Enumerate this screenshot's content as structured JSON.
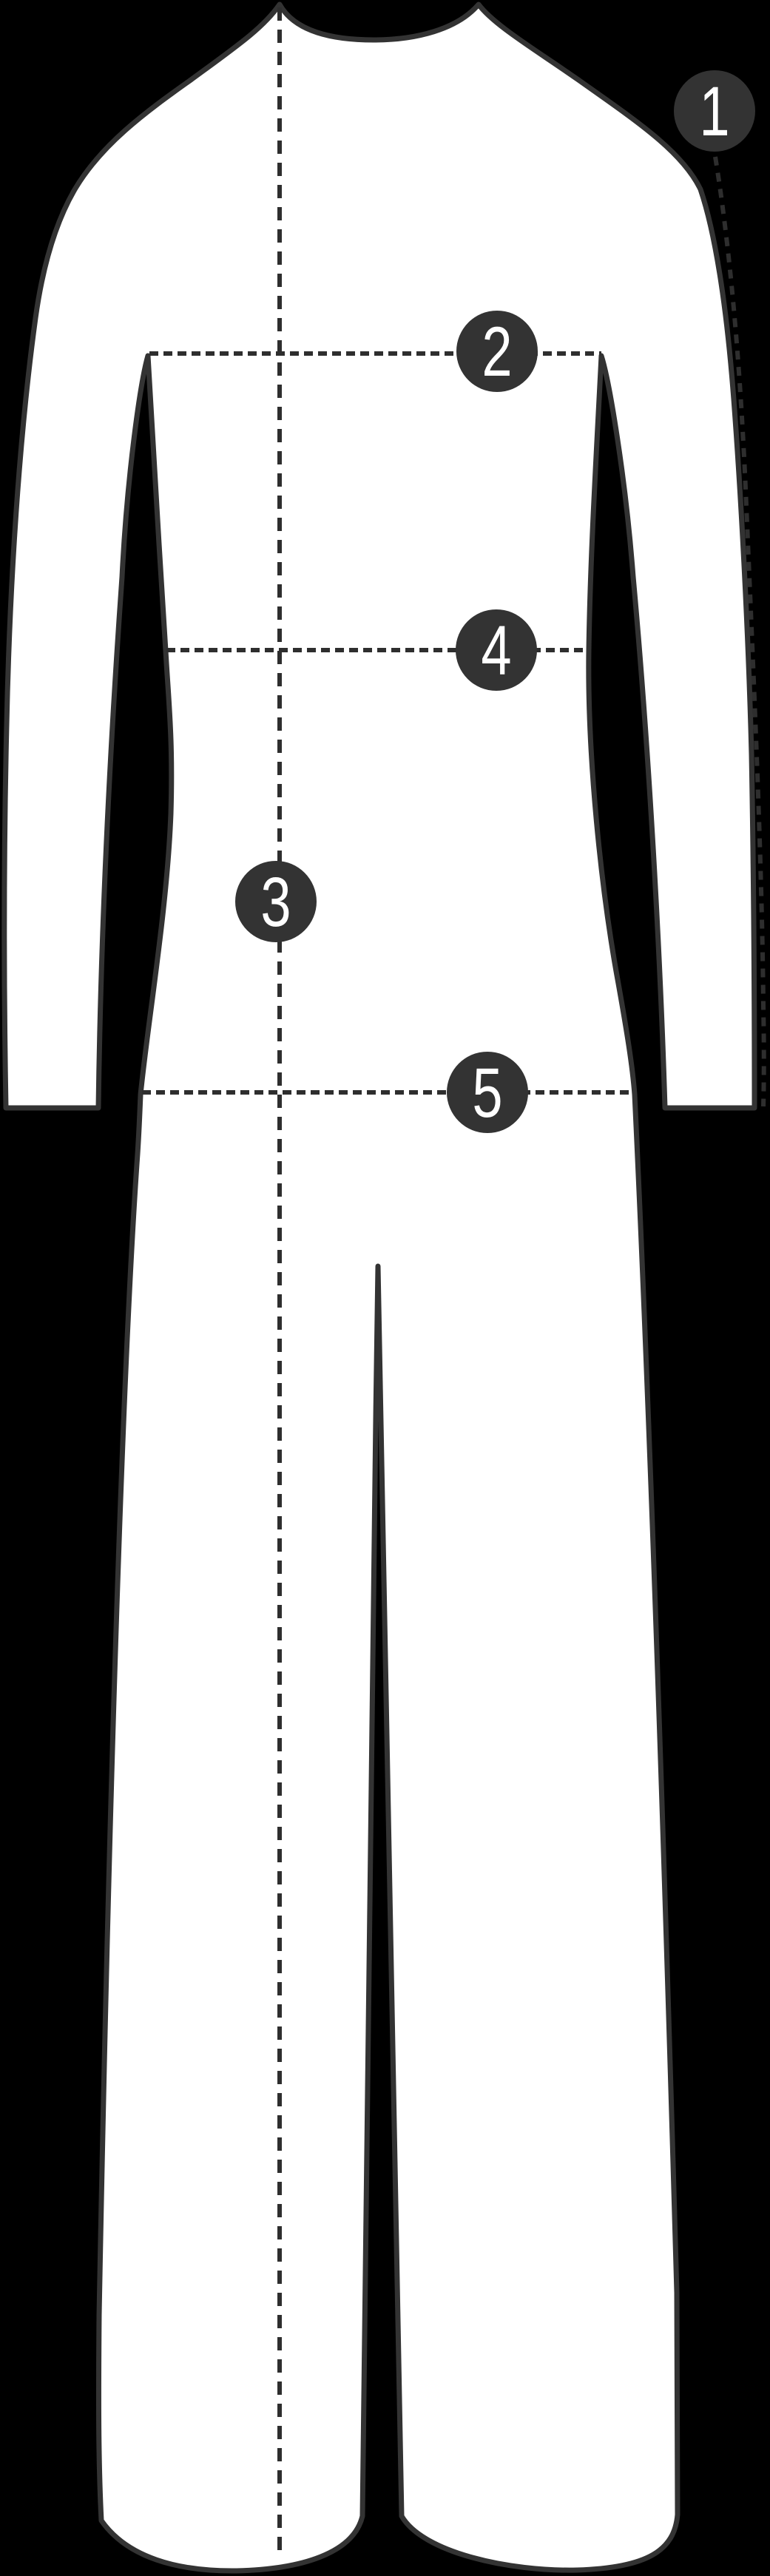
{
  "diagram": {
    "markers": [
      {
        "number": "1"
      },
      {
        "number": "2"
      },
      {
        "number": "3"
      },
      {
        "number": "4"
      },
      {
        "number": "5"
      }
    ],
    "colors": {
      "background": "#000000",
      "garment_fill": "#ffffff",
      "garment_outline": "#333333",
      "measure_line": "#2e2e2e",
      "marker_fill": "#333333",
      "marker_number": "#ffffff"
    }
  }
}
